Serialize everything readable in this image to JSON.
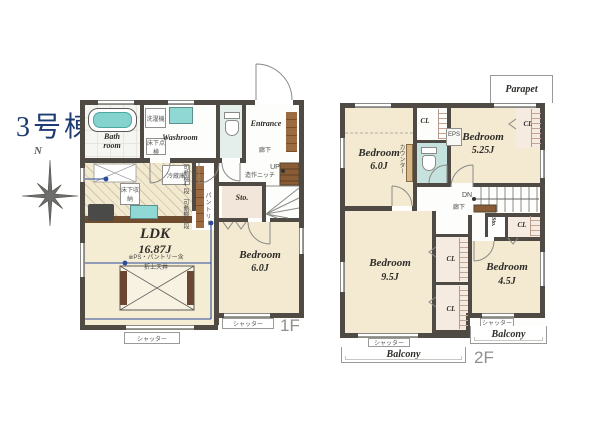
{
  "building": "3号棟",
  "north": "N",
  "colors": {
    "wall": "#4f4a44",
    "water_teal": "#8fd8d4",
    "wood_brown": "#8a5c36",
    "annotation_blue": "#2b4c9b",
    "title_navy": "#1e3b72",
    "floor_cream": "#f3ead1"
  },
  "f1": {
    "label": "1F",
    "bath": "Bath room",
    "washroom": "Washroom",
    "washer": "洗濯機",
    "inspection": "床下点検",
    "entrance": "Entrance",
    "hall": "廊下",
    "up": "UP",
    "niche": "造作ニッチ",
    "storage": "Sto.",
    "pantry": "パントリー",
    "shelf": "可動棚4段",
    "fridge": "冷蔵庫",
    "underfloor": "床下収納",
    "ldk": "LDK",
    "ldk_size": "16.87J",
    "ldk_note": "※PS・パントリー含",
    "ceiling": "折上天井",
    "bedroom": "Bedroom",
    "bedroom_size": "6.0J",
    "shutter": "シャッター"
  },
  "f2": {
    "label": "2F",
    "parapet": "Parapet",
    "bedroom": "Bedroom",
    "b6": "6.0J",
    "b525": "5.25J",
    "b95": "9.5J",
    "b45": "4.5J",
    "counter": "カウンター",
    "cl": "CL",
    "eps": "EPS",
    "dn": "DN",
    "hall": "廊下",
    "storage": "Sto.",
    "shutter": "シャッター",
    "balcony": "Balcony"
  }
}
